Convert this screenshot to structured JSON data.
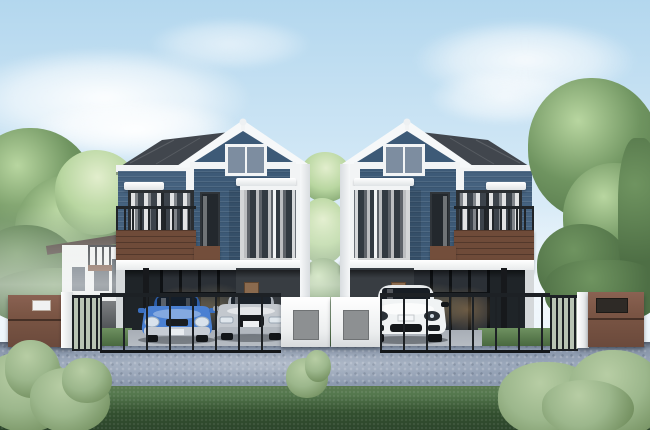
{
  "scene": {
    "type": "architectural-rendering",
    "description": "3D rendering of twin two-storey duplex houses with blue horizontal siding, white trim, dark grey gabled roofs, wooden balconies, glass-walled carports with parked cars, a black metal fence with brown gate walls and white pillars, green trees behind, a grey road and dark green grass with bushes in the foreground under a pale blue sky with clouds",
    "houses": [
      {
        "id": "house-left",
        "storeys": 2,
        "facade": "blue siding with white trim",
        "roof": "dark grey gable with white fascia and ball finial",
        "balcony_side": "left",
        "features": [
          "attic window",
          "balcony with dark railing and wood panel",
          "narrow dark-framed window",
          "white-framed window with curtains",
          "glass-walled carport",
          "charcoal entry wall with brown door"
        ],
        "cars": [
          "blue compact car",
          "silver sedan"
        ]
      },
      {
        "id": "house-right",
        "storeys": 2,
        "facade": "blue siding with white trim",
        "roof": "dark grey gable with white fascia and ball finial",
        "balcony_side": "right",
        "features": [
          "mirror image of left house"
        ],
        "cars": [
          "white SUV"
        ]
      }
    ],
    "fence": {
      "style": "black vertical-bar fence",
      "left_gate_wall": "brown wall with small white house-number plate",
      "right_gate_wall": "brown wall with dark mailbox slot",
      "pillars": "white",
      "center": "two white gate posts with grey inset panels"
    },
    "background": {
      "left": "small white two-storey house with brown-railed balcony behind trees",
      "middle": "sunlit light-green trees between the twin houses",
      "right": "large green tree with brown trunk"
    },
    "foreground": {
      "road": "grey-blue asphalt with light sheen",
      "grass": "dark green strip",
      "bushes": [
        "bottom-left sage bush",
        "small center sprig",
        "bottom-right sage bush"
      ]
    },
    "sky": {
      "condition": "clear pale blue with soft white clouds"
    }
  },
  "palette": {
    "sky_top": "#b3d7ee",
    "sky_horizon": "#ecf5fb",
    "roof_dark": "#41464d",
    "trim_white": "#f2f4f5",
    "wall_blue": "#45627f",
    "gable_blue": "#3d5a77",
    "wood_brown": "#6f4b39",
    "accent_brown": "#734e3b",
    "gate_brown": "#7a5544",
    "fence_black": "#1d2125",
    "interior_dark": "#1f2428",
    "wall_charcoal": "#383d42",
    "door_brown": "#8a6a4e",
    "panel_gray": "#8d9092",
    "road_light": "#9aa7ba",
    "road_dark": "#7f8da2",
    "concrete": "#b6bcc3",
    "grass_dark": "#33502f",
    "grass_mid": "#55784e",
    "grass_lit": "#9cb78c",
    "tree_green": "#6f9460",
    "tree_dark": "#4e6f45",
    "tree_lit": "#b8d6a0",
    "trunk_brown": "#5a4636",
    "car_blue": "#4a80d2",
    "car_silver": "#c3c8ce",
    "car_white": "#f0f3f4"
  }
}
